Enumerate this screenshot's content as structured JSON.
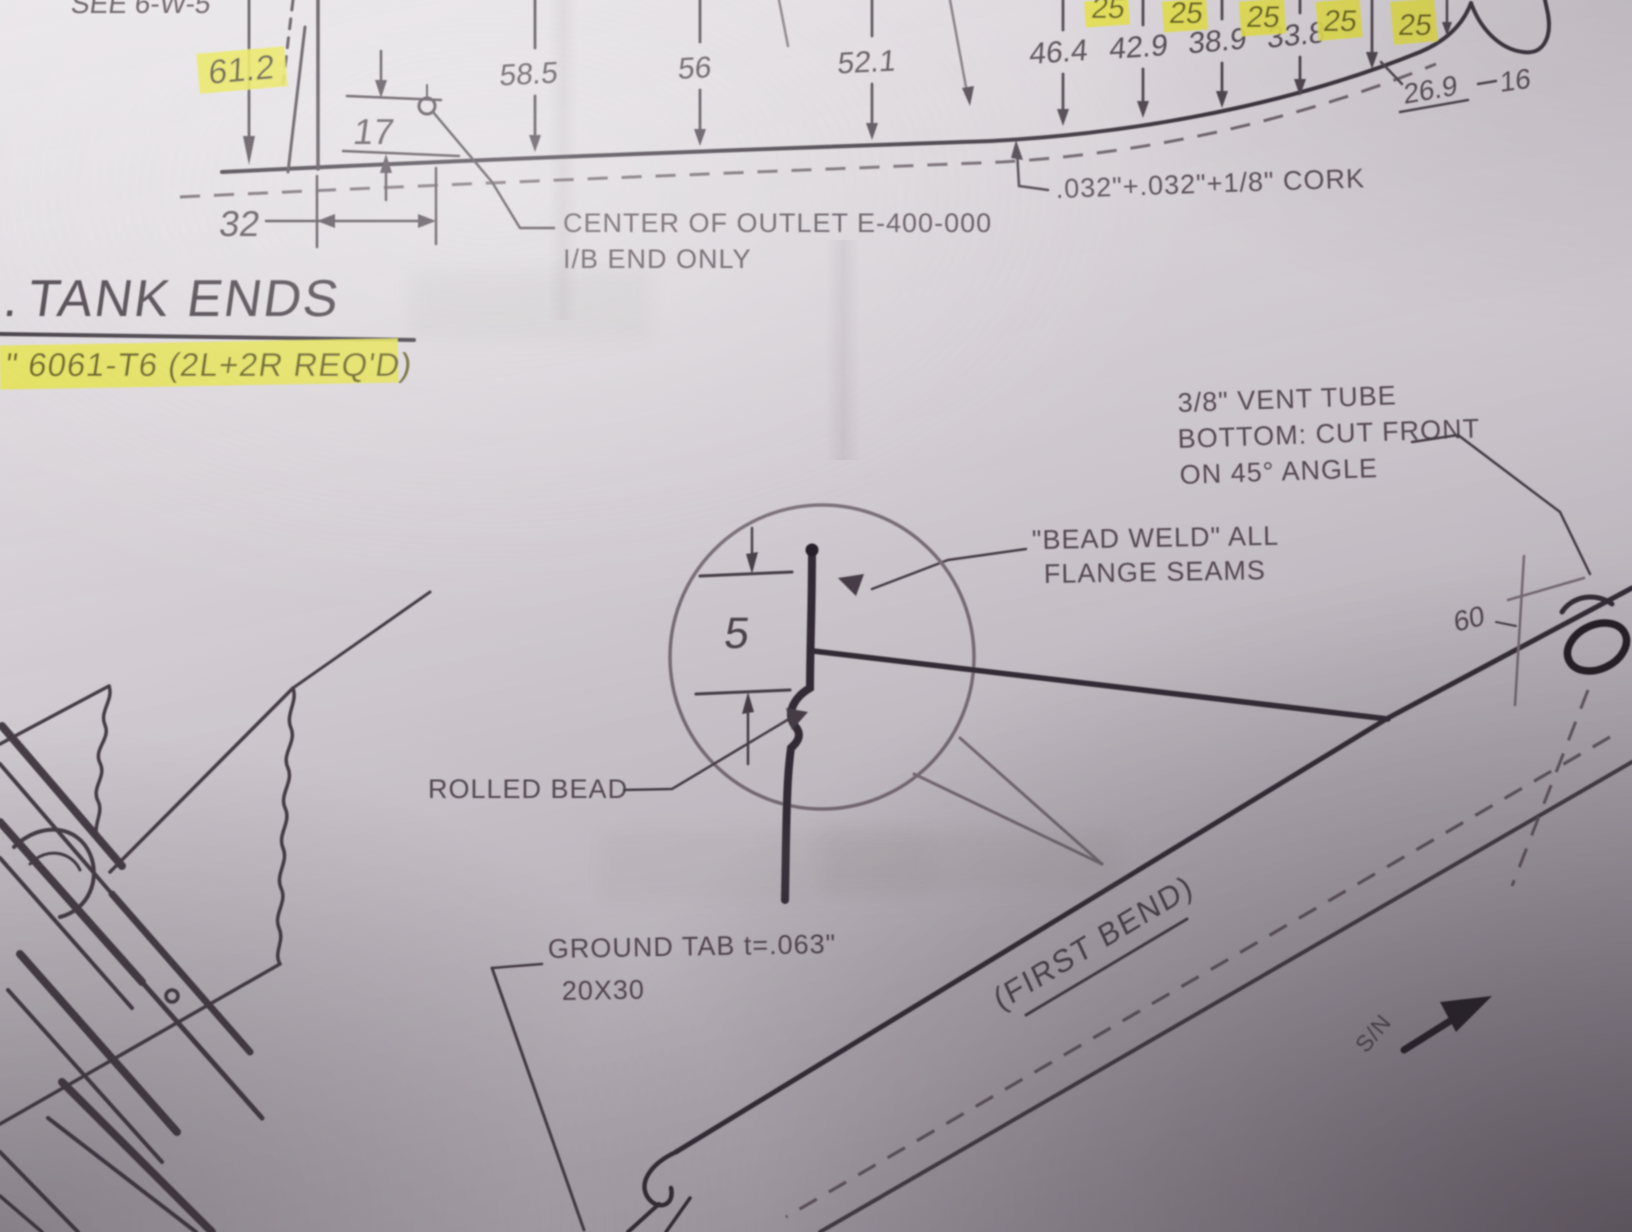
{
  "colors": {
    "paper": "#d8d3d8",
    "ink": "#544851",
    "ink_dark": "#2d262e",
    "highlight": "#e8e445",
    "highlight_text": "#625a12"
  },
  "top_profile": {
    "see_note": "SEE 6-W-5",
    "dim_61_2": "61.2",
    "dim_17": "17",
    "dim_32": "32",
    "stations": [
      "58.5",
      "56",
      "52.1",
      "46.4",
      "42.9",
      "38.9",
      "33.8"
    ],
    "chain_dims": [
      "25",
      "25",
      "25",
      "25",
      "25"
    ],
    "dim_26_9": "26.9",
    "dim_16": "16",
    "cork_note": ".032\"+.032\"+1/8\" CORK",
    "outlet_note_line1": "CENTER OF OUTLET E-400-000",
    "outlet_note_line2": "I/B END ONLY"
  },
  "title_block": {
    "partial_prefix": ".",
    "section_title": "TANK ENDS",
    "material_spec": "\" 6061-T6 (2L+2R REQ'D)"
  },
  "detail": {
    "vent_note_line1": "3/8\" VENT TUBE",
    "vent_note_line2": "BOTTOM: CUT FRONT",
    "vent_note_line3": "ON 45° ANGLE",
    "bead_weld_line1": "\"BEAD WELD\" ALL",
    "bead_weld_line2": "FLANGE SEAMS",
    "dim_5": "5",
    "rolled_bead_label": "ROLLED BEAD",
    "ground_tab_line1": "GROUND TAB t=.063\"",
    "ground_tab_line2": "20X30",
    "first_bend_label": "(FIRST BEND)",
    "sn_label": "S/N",
    "dim_60": "60"
  }
}
